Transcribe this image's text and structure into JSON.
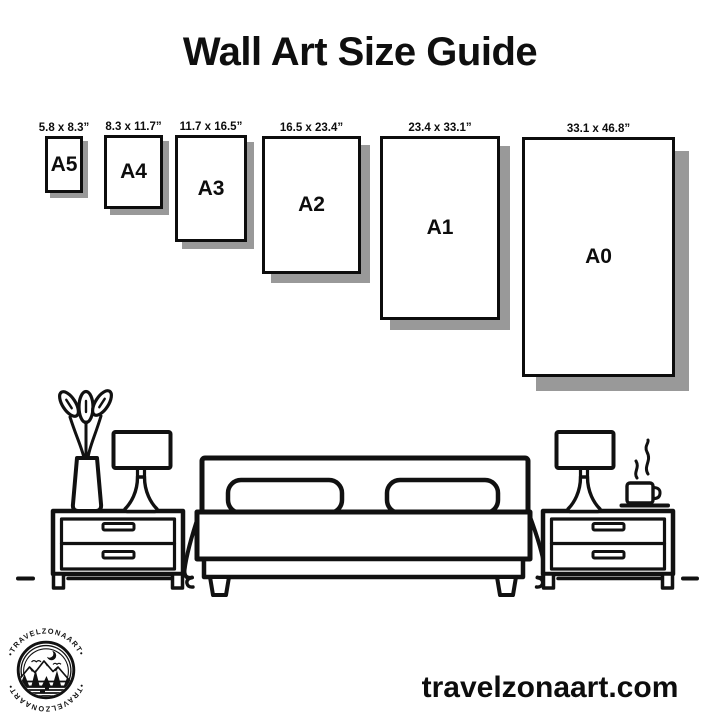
{
  "poster": {
    "title": "Wall Art Size Guide"
  },
  "sizes": [
    {
      "code": "A5",
      "dimensions": "5.8 x 8.3”"
    },
    {
      "code": "A4",
      "dimensions": "8.3 x 11.7”"
    },
    {
      "code": "A3",
      "dimensions": "11.7 x 16.5”"
    },
    {
      "code": "A2",
      "dimensions": "16.5 x 23.4”"
    },
    {
      "code": "A1",
      "dimensions": "23.4 x 33.1”"
    },
    {
      "code": "A0",
      "dimensions": "33.1 x 46.8”"
    }
  ],
  "logo": {
    "brand": "TRAVELZONAART",
    "arc_text": "•TRAVELZONAART•"
  },
  "footer": {
    "website": "travelzonaart.com"
  },
  "colors": {
    "ink": "#111111",
    "shadow": "#999999",
    "background": "#ffffff"
  }
}
